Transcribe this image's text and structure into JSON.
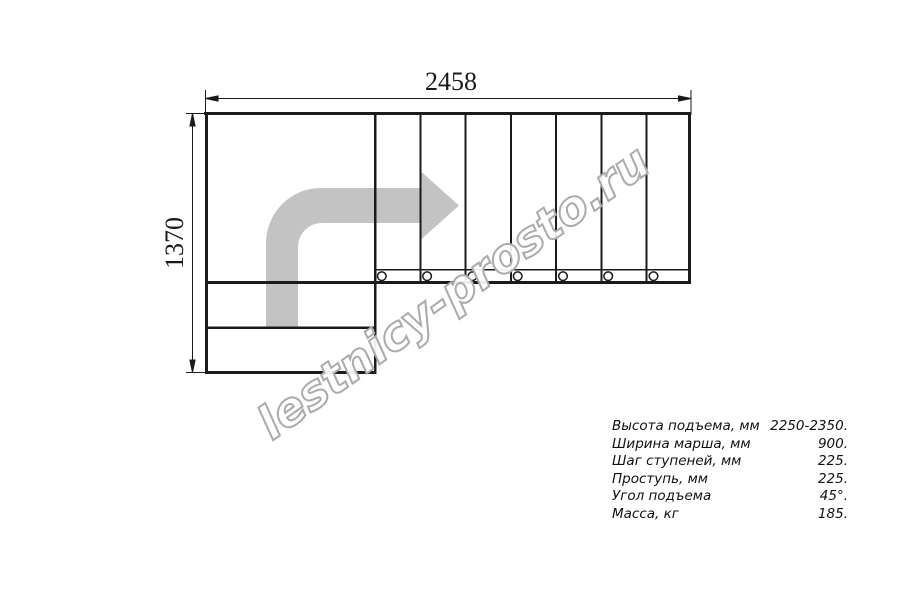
{
  "drawing": {
    "title": "stair-plan-top-view",
    "dimensions": {
      "width_label": "2458",
      "height_label": "1370"
    },
    "watermark": "lestnicy-prosto.ru",
    "colors": {
      "line": "#1b1b1b",
      "dimension_line": "#1a1a1a",
      "arrow": "#c3c3c3",
      "watermark_stroke": "#ababab",
      "background": "#ffffff"
    },
    "plan": {
      "straight_run_steps": 7,
      "lower_steps": 2,
      "baluster_circles": 7
    }
  },
  "specs": {
    "rows": [
      {
        "label": "Высота подъема, мм",
        "value": "2250-2350."
      },
      {
        "label": "Ширина марша, мм",
        "value": "900."
      },
      {
        "label": "Шаг ступеней, мм",
        "value": "225."
      },
      {
        "label": "Проступь, мм",
        "value": "225."
      },
      {
        "label": "Угол подъема",
        "value": "45°."
      },
      {
        "label": "Масса, кг",
        "value": "185."
      }
    ]
  }
}
